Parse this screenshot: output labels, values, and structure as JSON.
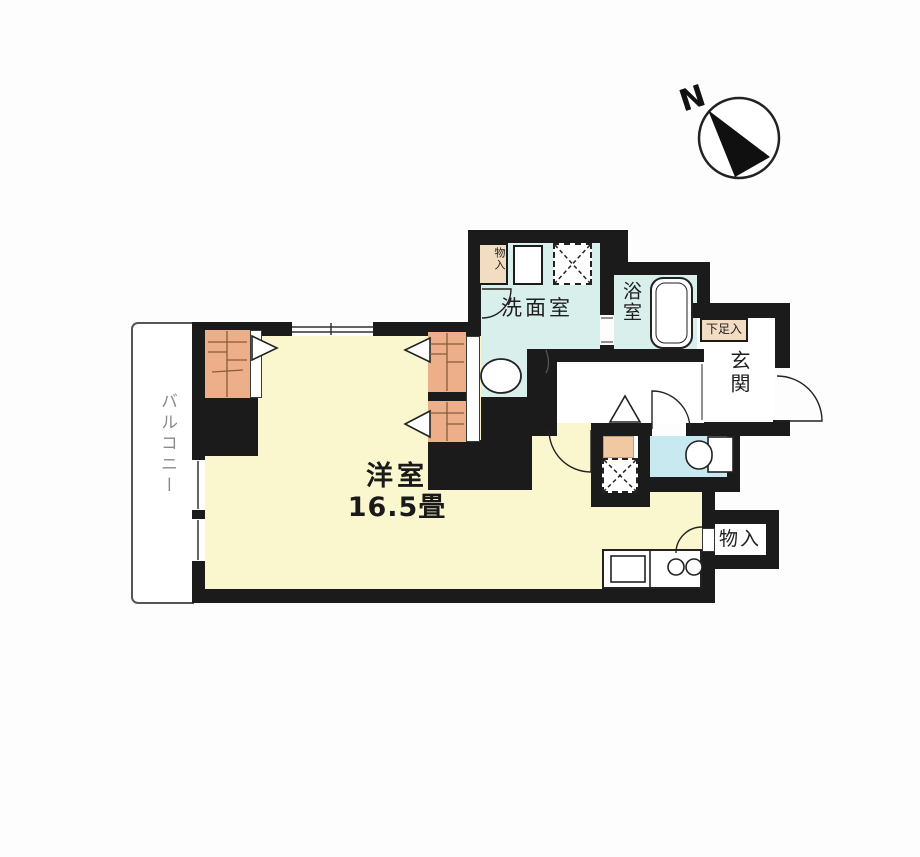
{
  "compass": {
    "north_label": "N"
  },
  "plan": {
    "balcony_label": "バルコニー",
    "main_room_label": "洋室",
    "main_room_size": "16.5畳",
    "washroom_label": "洗面室",
    "bath_label": "浴室",
    "entrance_label": "玄関",
    "shoe_storage_label": "下足入",
    "storage_top_label": "物入",
    "storage_bottom_label": "物入"
  },
  "colors": {
    "wall": "#1b1b1b",
    "main_room_fill": "#faf7cf",
    "wet_area_fill": "#d9efeb",
    "toilet_fill": "#c9e9f1",
    "closet_fill": "#ecaf8a",
    "cabinet_fill": "#f2dcc2",
    "counter_step_fill": "#f0c9a2",
    "balcony_text": "#8a8a8a",
    "line": "#222222"
  },
  "symbols": [
    "compass-icon",
    "folding-door-icon",
    "door-swing-arc",
    "washing-machine-place-icon",
    "refrigerator-place-icon",
    "wash-basin-icon",
    "bathtub-icon",
    "toilet-icon",
    "kitchen-sink-icon",
    "stove-burners-icon",
    "window-glass-lines"
  ]
}
